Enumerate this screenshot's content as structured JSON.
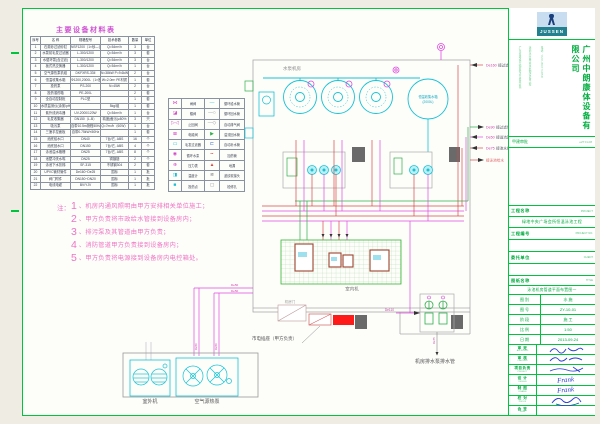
{
  "equipment_table": {
    "title": "主要设备材料表",
    "headers": [
      "序号",
      "名  称",
      "规格型号",
      "技术参数",
      "数量",
      "单位"
    ],
    "rows": [
      [
        "1",
        "石英砂过滤砂缸",
        "NSF1200（1×砂—含介质）",
        "Q=54m³/h",
        "3",
        "台"
      ],
      [
        "2",
        "水泵前毛发过滤器",
        "L-300/1200",
        "Q=54m³/h",
        "3",
        "套"
      ],
      [
        "3",
        "水循环泵(含过滤)",
        "L-300/1200",
        "Q=54m³/h",
        "3",
        "台"
      ],
      [
        "4",
        "板式热交换器",
        "L-300/1200",
        "Q=54m³/h",
        "1",
        "台"
      ],
      [
        "5",
        "空气源热泵机组",
        "DKFXRS-33II",
        "N=38kW  P=9.6kW",
        "2",
        "台"
      ],
      [
        "6",
        "恒温收集水箱",
        "Φ1200,2000L（1×胶—含阀）",
        "W=2.0m³  PE材质",
        "1",
        "套"
      ],
      [
        "7",
        "投药泵",
        "PS-200",
        "N=45W",
        "2",
        "台"
      ],
      [
        "8",
        "投药溶药箱",
        "PE-200L",
        "",
        "2",
        "套"
      ],
      [
        "9",
        "全自动控制柜",
        "PLC型",
        "",
        "1",
        "套"
      ],
      [
        "10",
        "水质监测仪(余氯/pH值)",
        "",
        "5kg/组",
        "1",
        "套"
      ],
      [
        "11",
        "紫外线消毒器",
        "UV-2000/120W",
        "Q=54m³/h",
        "1",
        "台"
      ],
      [
        "12",
        "毛发收集器",
        "DN150（L-B）",
        "精度(截污)≥80%",
        "3",
        "只"
      ],
      [
        "13",
        "吸污泵",
        "自带10.5m扬程50Hz",
        "Q=7m³/h（60W）",
        "1",
        "台"
      ],
      [
        "14",
        "三速手控面板",
        "自带0.75kW×50Hz",
        "",
        "1",
        "套"
      ],
      [
        "15",
        "池底给水口",
        "DN40",
        "7台/它, ABS",
        "16",
        "个"
      ],
      [
        "16",
        "池底回水口",
        "DN150",
        "7台/它, ABS",
        "4",
        "个"
      ],
      [
        "17",
        "泳池溢水格栅",
        "DN25",
        "7台/它, ABS",
        "8",
        "个"
      ],
      [
        "18",
        "池壁冲洗水嘴",
        "DN25",
        "铜镀铬",
        "2",
        "个"
      ],
      [
        "19",
        "泳池下水扶梯",
        "SF-315",
        "不锈钢304",
        "2",
        "套"
      ],
      [
        "20",
        "UPVC管材管件",
        "De160~De25",
        "国标",
        "1",
        "批"
      ],
      [
        "21",
        "阀门附件",
        "DN150~DN20",
        "国标",
        "1",
        "批"
      ],
      [
        "22",
        "电线电缆",
        "BV/YJV",
        "国标",
        "1",
        "批"
      ]
    ]
  },
  "legend": {
    "rows": [
      {
        "s1": "⋈",
        "c1": "#d348c8",
        "l1": "闸阀",
        "s2": "—",
        "c2": "#19bfd4",
        "l2": "循环给水管"
      },
      {
        "s1": "◪",
        "c1": "#d348c8",
        "l1": "蝶阀",
        "s2": "—○",
        "c2": "#8a8f99",
        "l2": "循环回水管"
      },
      {
        "s1": "▷◁",
        "c1": "#d348c8",
        "l1": "止回阀",
        "s2": "—◇",
        "c2": "#8a8f99",
        "l2": "自动排气阀"
      },
      {
        "s1": "⊠",
        "c1": "#d348c8",
        "l1": "电磁阀",
        "s2": "▶",
        "c2": "#2fae4c",
        "l2": "溢流回水管"
      },
      {
        "s1": "▭",
        "c1": "#19bfd4",
        "l1": "毛发过滤器",
        "s2": "⊏",
        "c2": "#3a6fd8",
        "l2": "自动补水管"
      },
      {
        "s1": "◉",
        "c1": "#d348c8",
        "l1": "循环水泵",
        "s2": "╍",
        "c2": "#d84848",
        "l2": "加药管"
      },
      {
        "s1": "⊕",
        "c1": "#d348c8",
        "l1": "压力表",
        "s2": "▲",
        "c2": "#d84848",
        "l2": "地漏"
      },
      {
        "s1": "◨",
        "c1": "#19bfd4",
        "l1": "温度计",
        "s2": "≋",
        "c2": "#666666",
        "l2": "波纹软接头"
      },
      {
        "s1": "■",
        "c1": "#19bfd4",
        "l1": "投药点",
        "s2": "▢",
        "c2": "#8a8f99",
        "l2": "检修孔"
      }
    ]
  },
  "notes": {
    "prefix": "注：",
    "items": [
      {
        "n": "1",
        "t": "、机房内通风照明由甲方安排相关单位施工；"
      },
      {
        "n": "2",
        "t": "、甲方负责将市政给水管接到设备房内；"
      },
      {
        "n": "3",
        "t": "、排污泵及其管道由甲方负责；"
      },
      {
        "n": "4",
        "t": "、消防管道甲方负责接到设备房内；"
      },
      {
        "n": "5",
        "t": "、甲方负责将电源接到设备房内电控箱处。"
      }
    ]
  },
  "schematic": {
    "pump_room": "水泵机房",
    "tank_line1": "恒温收集水箱",
    "tank_line2": "(2000L)",
    "indoor_unit": "室内机",
    "door": "机房门",
    "socket": "市电插座（甲方负责）",
    "drain_text": "机房排水泵排水管",
    "outdoor_unit": "室外机",
    "heat_pump": "空气源热泵",
    "pipe_labels": {
      "de110": "De110",
      "de75": "De75",
      "de50": "De50"
    },
    "arrows": [
      {
        "size": "De160",
        "name": "接过滤回水"
      },
      {
        "size": "De90",
        "name": "接过滤供水"
      },
      {
        "size": "De50",
        "name": "接溢流回水"
      },
      {
        "size": "De75",
        "name": "接池水排污"
      },
      {
        "size": "",
        "name": "接泳池给水"
      }
    ]
  },
  "titleblock": {
    "logo_text": "JUSSEN",
    "company": "广州中朗康体设备有限公司",
    "cert1": "广东省建设厅颁发专业资质证书",
    "cert2": "泳池水疗桑拿水处理设备工程",
    "cert3": "电话：020-86071858",
    "approval_label": "甲建审批",
    "approval_value": "eZT.FL08",
    "project_label": "工程名称",
    "project_en": "PROJECT",
    "project_value": "绿地中央广场会所恒温泳池工程",
    "projno_label": "工程编号",
    "projno_en": "PROJECT NO.",
    "client_label": "委托单位",
    "client_en": "CLIENT",
    "title_label": "图纸名称",
    "title_en": "TITLE",
    "drawing_title": "泳池机房管道平面布置图一",
    "meta": [
      [
        "图 别",
        "水 施"
      ],
      [
        "图 号",
        "ZY-10-01"
      ],
      [
        "阶 段",
        "施 工"
      ],
      [
        "比 例",
        "1:50"
      ],
      [
        "日 期",
        "2013-09-24"
      ]
    ],
    "sigs": [
      [
        "审 定",
        "APPROVED"
      ],
      [
        "审 核",
        "CHECKED"
      ],
      [
        "项目负责",
        "PROJECT"
      ],
      [
        "设 计",
        "DESIGN"
      ],
      [
        "制 图",
        "DRAWN"
      ],
      [
        "校 对",
        "PROOF"
      ],
      [
        "会 签",
        "SIGN"
      ]
    ],
    "sig_values": [
      "",
      "",
      "",
      "Frank",
      "Frank",
      "",
      ""
    ]
  }
}
